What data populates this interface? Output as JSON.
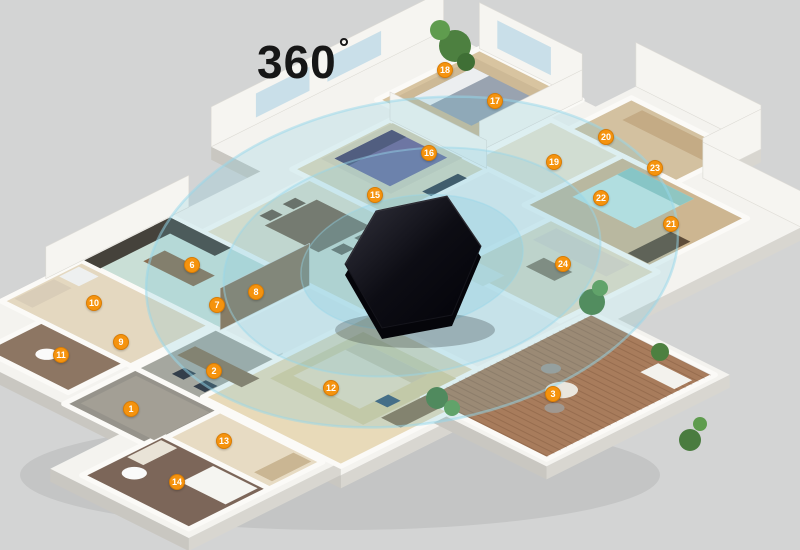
{
  "scene": {
    "title": {
      "text": "360",
      "degree": "°"
    },
    "background_color": "#d3d4d4",
    "badge_color": "#f5930e",
    "coverage_color": "#69c1de",
    "iso": {
      "cx": 390,
      "cy": 272,
      "ax": 0.894,
      "ay": 0.447
    },
    "slab_fill": "#f4f3ef",
    "slab_depth": 13,
    "wall_fill": "#f6f5f1",
    "window_fill": "#c9dfe9",
    "badges": [
      {
        "n": "1",
        "x": 131,
        "y": 409
      },
      {
        "n": "2",
        "x": 214,
        "y": 371
      },
      {
        "n": "3",
        "x": 553,
        "y": 394
      },
      {
        "n": "6",
        "x": 192,
        "y": 265
      },
      {
        "n": "7",
        "x": 217,
        "y": 305
      },
      {
        "n": "8",
        "x": 256,
        "y": 292
      },
      {
        "n": "9",
        "x": 121,
        "y": 342
      },
      {
        "n": "10",
        "x": 94,
        "y": 303
      },
      {
        "n": "11",
        "x": 61,
        "y": 355
      },
      {
        "n": "12",
        "x": 331,
        "y": 388
      },
      {
        "n": "13",
        "x": 224,
        "y": 441
      },
      {
        "n": "14",
        "x": 177,
        "y": 482
      },
      {
        "n": "15",
        "x": 375,
        "y": 195
      },
      {
        "n": "16",
        "x": 429,
        "y": 153
      },
      {
        "n": "17",
        "x": 495,
        "y": 101
      },
      {
        "n": "18",
        "x": 445,
        "y": 70
      },
      {
        "n": "19",
        "x": 554,
        "y": 162
      },
      {
        "n": "20",
        "x": 606,
        "y": 137
      },
      {
        "n": "21",
        "x": 671,
        "y": 224
      },
      {
        "n": "22",
        "x": 601,
        "y": 198
      },
      {
        "n": "23",
        "x": 655,
        "y": 168
      },
      {
        "n": "24",
        "x": 563,
        "y": 264
      }
    ],
    "slabs": [
      {
        "name": "top-left-wing",
        "u": -240,
        "v": -300,
        "w": 220,
        "h": 260
      },
      {
        "name": "top-right-tip",
        "u": -70,
        "v": -345,
        "w": 140,
        "h": 95
      },
      {
        "name": "right-wing",
        "u": -45,
        "v": -280,
        "w": 225,
        "h": 250
      },
      {
        "name": "center",
        "u": -185,
        "v": -60,
        "w": 385,
        "h": 315
      },
      {
        "name": "left-wing",
        "u": -185,
        "v": 150,
        "w": 215,
        "h": 180
      },
      {
        "name": "bath-wing",
        "u": 30,
        "v": 240,
        "w": 155,
        "h": 170
      },
      {
        "name": "balcony",
        "u": 150,
        "v": -75,
        "w": 155,
        "h": 205
      }
    ],
    "rooms": [
      {
        "name": "master-bedroom",
        "u": -200,
        "v": -300,
        "w": 115,
        "h": 115,
        "fill": "#d8c4a0"
      },
      {
        "name": "bedroom-top",
        "u": -170,
        "v": -170,
        "w": 110,
        "h": 110,
        "fill": "#e3d7ba"
      },
      {
        "name": "hallway-top",
        "u": -80,
        "v": -260,
        "w": 90,
        "h": 90,
        "fill": "#ece4d0"
      },
      {
        "name": "suite-top-right",
        "u": -60,
        "v": -330,
        "w": 120,
        "h": 70,
        "fill": "#d3c1a0"
      },
      {
        "name": "bedroom-right",
        "u": 0,
        "v": -260,
        "w": 140,
        "h": 110,
        "fill": "#cdb691"
      },
      {
        "name": "lounge-right",
        "u": 30,
        "v": -150,
        "w": 120,
        "h": 110,
        "fill": "#e6dcc4"
      },
      {
        "name": "living-dining",
        "u": -150,
        "v": -60,
        "w": 180,
        "h": 120,
        "fill": "#ece2c8"
      },
      {
        "name": "kitchen",
        "u": -185,
        "v": 60,
        "w": 155,
        "h": 100,
        "fill": "#c9dfd6"
      },
      {
        "name": "laundry",
        "u": -185,
        "v": 160,
        "w": 145,
        "h": 90,
        "fill": "#e4d8c0"
      },
      {
        "name": "bath-small",
        "u": -140,
        "v": 250,
        "w": 95,
        "h": 65,
        "fill": "#8d7663"
      },
      {
        "name": "study",
        "u": -35,
        "v": 160,
        "w": 105,
        "h": 90,
        "fill": "#a5a79f"
      },
      {
        "name": "foyer",
        "u": -35,
        "v": 250,
        "w": 105,
        "h": 80,
        "fill": "#96938b"
      },
      {
        "name": "corridor",
        "u": 60,
        "v": 250,
        "w": 115,
        "h": 60,
        "fill": "#e7dbc3"
      },
      {
        "name": "bathroom",
        "u": 55,
        "v": 310,
        "w": 120,
        "h": 90,
        "fill": "#7c6659"
      },
      {
        "name": "bedroom-bottom",
        "u": 35,
        "v": 60,
        "w": 155,
        "h": 185,
        "fill": "#e8dab9"
      },
      {
        "name": "balcony-deck",
        "u": 158,
        "v": -67,
        "w": 139,
        "h": 189,
        "fill": "#a87c5c"
      }
    ],
    "deck_stripes": {
      "u0": 160,
      "u1": 295,
      "v0": -64,
      "v1": 120,
      "step": 7,
      "color": "rgba(60,30,10,0.16)"
    },
    "walls": [
      {
        "u1": -240,
        "v1": -40,
        "u2": -240,
        "v2": -300,
        "h": 40
      },
      {
        "u1": -200,
        "v1": -300,
        "u2": -85,
        "v2": -300,
        "h": 46
      },
      {
        "u1": -85,
        "v1": -300,
        "u2": -85,
        "v2": -185,
        "h": 30
      },
      {
        "u1": -70,
        "v1": -345,
        "u2": 70,
        "v2": -345,
        "h": 44
      },
      {
        "u1": 70,
        "v1": -345,
        "u2": 70,
        "v2": -280,
        "h": 40
      },
      {
        "u1": 70,
        "v1": -280,
        "u2": 180,
        "v2": -280,
        "h": 36
      },
      {
        "u1": -185,
        "v1": 40,
        "u2": -185,
        "v2": 200,
        "h": 32
      },
      {
        "u1": -170,
        "v1": -170,
        "u2": -62,
        "v2": -170,
        "h": 28
      },
      {
        "u1": -30,
        "v1": 60,
        "u2": -30,
        "v2": 160,
        "h": 42,
        "fill": "#8f6c4a"
      }
    ],
    "windows": [
      {
        "u1": -240,
        "v1": -90,
        "u2": -240,
        "v2": -150,
        "h": 24,
        "lift": 7
      },
      {
        "u1": -240,
        "v1": -170,
        "u2": -240,
        "v2": -230,
        "h": 24,
        "lift": 7
      },
      {
        "u1": -180,
        "v1": -300,
        "u2": -120,
        "v2": -300,
        "h": 28,
        "lift": 9
      }
    ],
    "furniture": [
      {
        "name": "master-rug",
        "u": -192,
        "v": -287,
        "w": 92,
        "h": 92,
        "fill": "#cdb996"
      },
      {
        "name": "master-bed",
        "u": -182,
        "v": -275,
        "w": 64,
        "h": 66,
        "fill": "#99a3b0"
      },
      {
        "name": "master-bed-head",
        "u": -182,
        "v": -275,
        "w": 18,
        "h": 66,
        "fill": "#eceef0"
      },
      {
        "name": "master-bench",
        "u": -150,
        "v": -200,
        "w": 36,
        "h": 10,
        "fill": "#b4a284"
      },
      {
        "name": "purple-rug",
        "u": -165,
        "v": -168,
        "w": 78,
        "h": 80,
        "fill": "#d8cdb2"
      },
      {
        "name": "purple-bed",
        "u": -158,
        "v": -160,
        "w": 62,
        "h": 64,
        "fill": "#6e6395"
      },
      {
        "name": "purple-bed-head",
        "u": -158,
        "v": -160,
        "w": 16,
        "h": 64,
        "fill": "#4c4569"
      },
      {
        "name": "tv-unit-top",
        "u": -72,
        "v": -148,
        "w": 10,
        "h": 40,
        "fill": "#2e2e36"
      },
      {
        "name": "wardrobe-suite",
        "u": -40,
        "v": -322,
        "w": 92,
        "h": 22,
        "fill": "#c4ab85"
      },
      {
        "name": "right-bed",
        "u": 18,
        "v": -252,
        "w": 70,
        "h": 66,
        "fill": "#c3e5e1"
      },
      {
        "name": "right-bed-head",
        "u": 18,
        "v": -252,
        "w": 70,
        "h": 16,
        "fill": "#8fc6c1"
      },
      {
        "name": "right-desk",
        "u": 112,
        "v": -202,
        "w": 22,
        "h": 48,
        "fill": "#5d4b38"
      },
      {
        "name": "lounge-sofa",
        "u": 44,
        "v": -142,
        "w": 82,
        "h": 26,
        "fill": "#ded3c1"
      },
      {
        "name": "lounge-table",
        "u": 70,
        "v": -102,
        "w": 32,
        "h": 20,
        "fill": "#8a7458"
      },
      {
        "name": "dining-table",
        "u": -122,
        "v": -40,
        "w": 60,
        "h": 58,
        "fill": "#7c593c"
      },
      {
        "name": "dining-chair",
        "u": -136,
        "v": -30,
        "w": 12,
        "h": 14,
        "fill": "#6a4c34"
      },
      {
        "name": "dining-chair",
        "u": -136,
        "v": -4,
        "w": 12,
        "h": 14,
        "fill": "#6a4c34"
      },
      {
        "name": "dining-chair",
        "u": -58,
        "v": -32,
        "w": 12,
        "h": 14,
        "fill": "#6a4c34"
      },
      {
        "name": "dining-chair",
        "u": -58,
        "v": -6,
        "w": 12,
        "h": 14,
        "fill": "#6a4c34"
      },
      {
        "name": "living-sofa",
        "u": -12,
        "v": -60,
        "w": 80,
        "h": 24,
        "fill": "#eae6db"
      },
      {
        "name": "coffee-table",
        "u": -2,
        "v": -28,
        "w": 36,
        "h": 16,
        "fill": "#d9d2c4"
      },
      {
        "name": "kitchen-counter",
        "u": -184,
        "v": 62,
        "w": 18,
        "h": 96,
        "fill": "#45423b"
      },
      {
        "name": "kitchen-counter",
        "u": -184,
        "v": 62,
        "w": 68,
        "h": 18,
        "fill": "#45423b"
      },
      {
        "name": "kitchen-island",
        "u": -150,
        "v": 102,
        "w": 56,
        "h": 24,
        "fill": "#8a6e52"
      },
      {
        "name": "washer",
        "u": -180,
        "v": 168,
        "w": 22,
        "h": 22,
        "fill": "#eef0f0"
      },
      {
        "name": "laundry-counter",
        "u": -180,
        "v": 196,
        "w": 20,
        "h": 44,
        "fill": "#d9cdb8"
      },
      {
        "name": "study-desk",
        "u": -26,
        "v": 192,
        "w": 72,
        "h": 20,
        "fill": "#8a7458"
      },
      {
        "name": "office-chair",
        "u": -8,
        "v": 222,
        "w": 13,
        "h": 14,
        "fill": "#343f4b"
      },
      {
        "name": "office-chair",
        "u": 18,
        "v": 224,
        "w": 13,
        "h": 14,
        "fill": "#343f4b"
      },
      {
        "name": "foyer-rug",
        "u": -26,
        "v": 258,
        "w": 82,
        "h": 62,
        "fill": "#a39f95"
      },
      {
        "name": "bathtub",
        "u": 118,
        "v": 316,
        "w": 50,
        "h": 36,
        "fill": "#f5f5f1"
      },
      {
        "name": "vanity",
        "u": 60,
        "v": 316,
        "w": 18,
        "h": 38,
        "fill": "#e9e3d7"
      },
      {
        "name": "hall-bench",
        "u": 148,
        "v": 256,
        "w": 20,
        "h": 44,
        "fill": "#cab693"
      },
      {
        "name": "bottom-rug",
        "u": 52,
        "v": 82,
        "w": 104,
        "h": 104,
        "fill": "#d9cb9c"
      },
      {
        "name": "bottom-bed",
        "u": 62,
        "v": 94,
        "w": 74,
        "h": 76,
        "fill": "#e4dabd"
      },
      {
        "name": "bottom-bed-head",
        "u": 62,
        "v": 94,
        "w": 74,
        "h": 18,
        "fill": "#cfc3a0"
      },
      {
        "name": "bottom-desk",
        "u": 158,
        "v": 118,
        "w": 22,
        "h": 50,
        "fill": "#8a7354"
      },
      {
        "name": "desk-chair",
        "u": 136,
        "v": 138,
        "w": 14,
        "h": 15,
        "fill": "#3c5a74"
      },
      {
        "name": "lounge-chair",
        "u": 252,
        "v": -48,
        "w": 38,
        "h": 20,
        "fill": "#f3f2ed"
      },
      {
        "name": "toilet",
        "type": "ellipse",
        "cu": -100,
        "cv": 284,
        "r": 9,
        "fill": "#fafafa"
      },
      {
        "name": "toilet",
        "type": "ellipse",
        "cu": 82,
        "cv": 368,
        "r": 10,
        "fill": "#fafafa"
      },
      {
        "name": "patio-table",
        "type": "ellipse",
        "cu": 228,
        "cv": 36,
        "r": 13,
        "fill": "#eae6de"
      },
      {
        "name": "patio-chair",
        "type": "ellipse",
        "cu": 198,
        "cv": 18,
        "r": 8,
        "fill": "#a09890"
      },
      {
        "name": "patio-chair",
        "type": "ellipse",
        "cu": 244,
        "cv": 60,
        "r": 8,
        "fill": "#a09890"
      }
    ],
    "plants": [
      {
        "x": 455,
        "y": 46,
        "r": 16,
        "fill": "#4d8040"
      },
      {
        "x": 440,
        "y": 30,
        "r": 10,
        "fill": "#5f9c4e"
      },
      {
        "x": 466,
        "y": 62,
        "r": 9,
        "fill": "#3f6f35"
      },
      {
        "x": 592,
        "y": 302,
        "r": 13,
        "fill": "#4d8040"
      },
      {
        "x": 600,
        "y": 288,
        "r": 8,
        "fill": "#5f9c4e"
      },
      {
        "x": 437,
        "y": 398,
        "r": 11,
        "fill": "#4a7c3f"
      },
      {
        "x": 452,
        "y": 408,
        "r": 8,
        "fill": "#5f9c4e"
      },
      {
        "x": 660,
        "y": 352,
        "r": 9,
        "fill": "#4d8040"
      },
      {
        "x": 690,
        "y": 440,
        "r": 11,
        "fill": "#4a7c3f"
      },
      {
        "x": 700,
        "y": 424,
        "r": 7,
        "fill": "#5f9c4e"
      }
    ],
    "coverage": {
      "cx": 412,
      "cy": 262,
      "rotate": -9,
      "rings": [
        {
          "rx": 268,
          "ry": 162,
          "fill_opacity": 0.2,
          "stroke_opacity": 0.5,
          "stroke_width": 2.5
        },
        {
          "rx": 190,
          "ry": 112,
          "fill_opacity": 0.16,
          "stroke_opacity": 0.45,
          "stroke_width": 2
        },
        {
          "rx": 112,
          "ry": 66,
          "fill_opacity": 0.2,
          "stroke_opacity": 0.4,
          "stroke_width": 1.5
        }
      ]
    },
    "device": {
      "label": "ir-remote-hub",
      "depth": 11,
      "points": [
        [
          345,
          264
        ],
        [
          376,
          211
        ],
        [
          447,
          196
        ],
        [
          481,
          246
        ],
        [
          452,
          315
        ],
        [
          382,
          328
        ]
      ],
      "shadow": {
        "cx": 415,
        "cy": 330,
        "rx": 80,
        "ry": 18
      }
    }
  }
}
